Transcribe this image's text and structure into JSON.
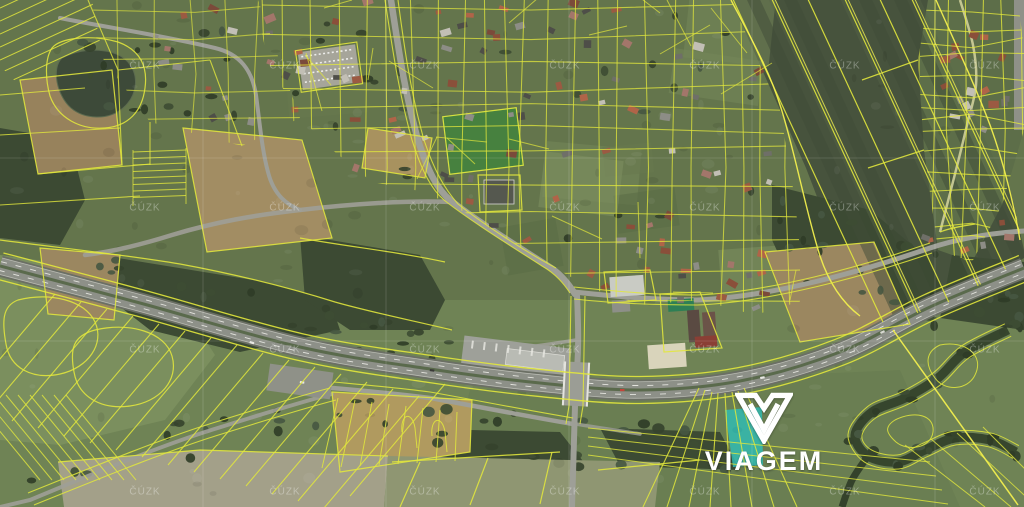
{
  "map_viewer": {
    "type": "satellite-cadastral-map",
    "provider_watermark": {
      "text": "ČÚZK"
    },
    "brand": {
      "logo_text": "VIAGEM",
      "logo_color": "#ffffff"
    },
    "overlay": {
      "parcel_line_color": "#e2e73c",
      "parcel_line_bright": "#f1ee4e",
      "highlighted_parcel_color": "#2fbdb5"
    }
  }
}
